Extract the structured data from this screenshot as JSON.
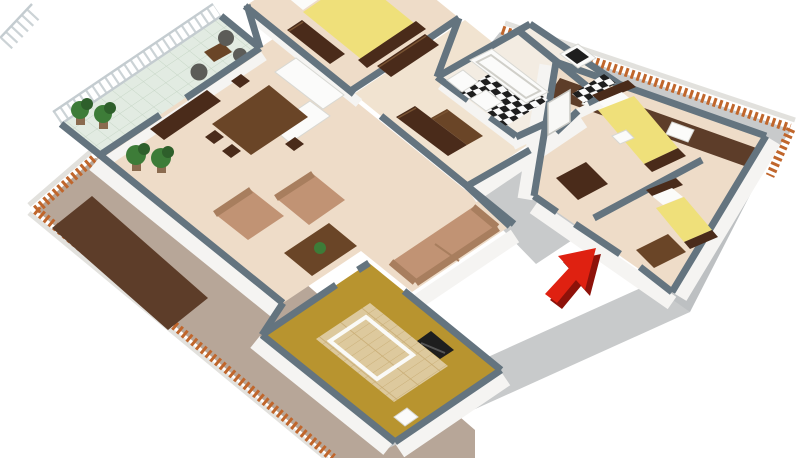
{
  "scene": {
    "type": "3d-floor-plan",
    "description": "Isometric 3D cutaway floor plan of an attic apartment surrounded by sloped roofs with terracotta tile ridges; a red arrow marks the entrance.",
    "rooms": [
      {
        "id": "balcony",
        "label": "Balcony"
      },
      {
        "id": "living-room",
        "label": "Living room"
      },
      {
        "id": "dining-area",
        "label": "Dining area"
      },
      {
        "id": "kitchen",
        "label": "Kitchen"
      },
      {
        "id": "master-bedroom",
        "label": "Master bedroom"
      },
      {
        "id": "bathroom",
        "label": "Bathroom"
      },
      {
        "id": "wc",
        "label": "WC"
      },
      {
        "id": "hallway",
        "label": "Hallway"
      },
      {
        "id": "child-bedroom-1",
        "label": "Bedroom 2"
      },
      {
        "id": "child-bedroom-2",
        "label": "Bedroom 3"
      },
      {
        "id": "study",
        "label": "Study / TV room"
      }
    ],
    "furniture": [
      "double bed",
      "single bed",
      "single bed",
      "sofa",
      "armchair",
      "armchair",
      "coffee table",
      "dining table",
      "dining chairs",
      "sideboard",
      "kitchen counters",
      "hall wardrobes",
      "dressers",
      "bathtub",
      "washbasin",
      "toilet",
      "toilet with black lid",
      "tv",
      "white rug",
      "potted plants",
      "balcony wicker chairs",
      "balcony table"
    ],
    "marker": {
      "id": "entrance-arrow",
      "meaning": "entrance pointer"
    }
  },
  "colors": {
    "bg": "#ffffff",
    "roof_tan": "#b7a698",
    "roof_gray": "#c8cacb",
    "roof_gray2": "#bdc0c2",
    "tile_orange": "#c0662c",
    "tile_dark": "#8a4214",
    "pent_brown": "#5d3d29",
    "wall_cap": "#64747f",
    "wall_face": "#f5f4f2",
    "floor_main": "#eedcc8",
    "floor_hall": "#f1e3d0",
    "floor_bath": "#f3ece2",
    "balcony_tile": "#e2ebe2",
    "balcony_line": "#c6d6c6",
    "gold": "#b8942f",
    "parquet": "#ddc99d",
    "parquet_line": "#c9ae76",
    "rug_white": "#fafaf7",
    "checker_dark": "#1e1e1e",
    "checker_light": "#fafafa",
    "fixture_white": "#fbfbfa",
    "wood_dark": "#4a2b1a",
    "wood_mid": "#6a4527",
    "bed_yellow": "#efe07a",
    "pillow": "#fbfbf9",
    "sofa": "#c19374",
    "sofa_dark": "#a87e5e",
    "green": "#3d7c38",
    "green_dark": "#2e5f2b",
    "pot": "#8a6b4f",
    "wicker": "#5c5c58",
    "arrow_red": "#df2111",
    "arrow_dark": "#8e120a",
    "door_white": "#f8f8f6"
  }
}
